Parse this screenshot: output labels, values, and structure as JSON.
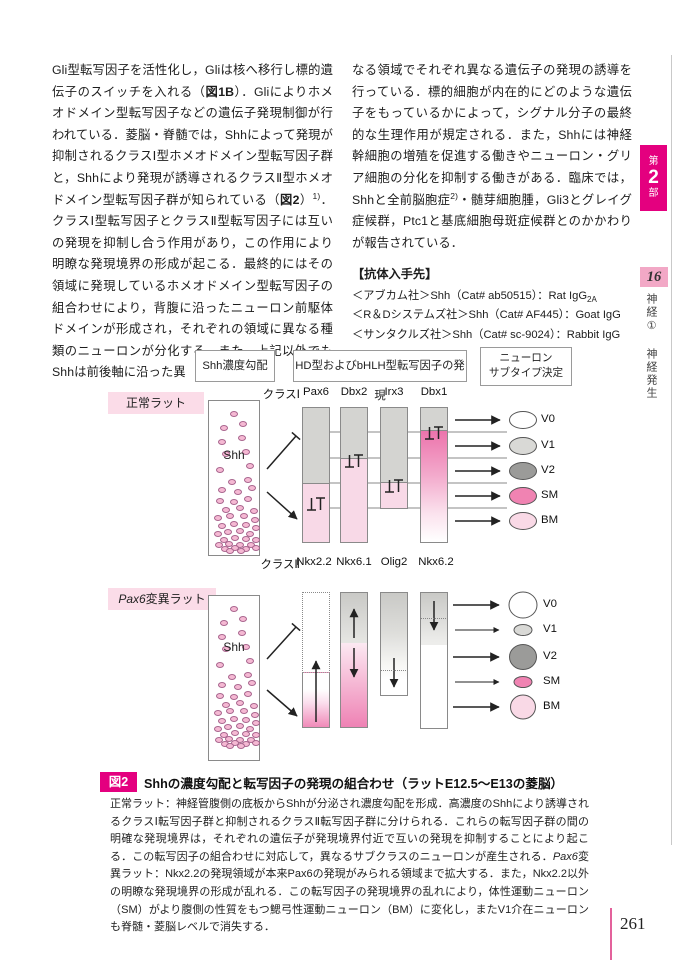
{
  "article": {
    "left_column_segments": [
      {
        "t": "Gli型転写因子を活性化し，Gliは核へ移行し標的遺伝子のスイッチを入れる（",
        "s": "n"
      },
      {
        "t": "図1B",
        "s": "b"
      },
      {
        "t": "）．Gliによりホメオドメイン型転写因子などの遺伝子発現制御が行われている．菱脳・脊髄では，Shhによって発現が抑制されるクラスⅠ型ホメオドメイン型転写因子群と，Shhにより発現が誘導されるクラスⅡ型ホメオドメイン型転写因子群が知られている（",
        "s": "n"
      },
      {
        "t": "図2",
        "s": "b"
      },
      {
        "t": "）",
        "s": "n"
      },
      {
        "t": "1)",
        "s": "sup"
      },
      {
        "t": "．クラスⅠ型転写因子とクラスⅡ型転写因子には互いの発現を抑制し合う作用があり，この作用により明瞭な発現境界の形成が起こる．最終的にはその領域に発現しているホメオドメイン型転写因子の組合わせにより，背腹に沿ったニューロン前駆体ドメインが形成され，それぞれの領域に異なる種類のニューロンが分化する．また，上記以外でもShhは前後軸に沿った異",
        "s": "n"
      }
    ],
    "right_column_segments": [
      {
        "t": "なる領域でそれぞれ異なる遺伝子の発現の誘導を行っている．標的細胞が内在的にどのような遺伝子をもっているかによって，シグナル分子の最終的な生理作用が規定される．また，Shhには神経幹細胞の増殖を促進する働きやニューロン・グリア細胞の分化を抑制する働きがある．臨床では，Shhと全前脳胞症",
        "s": "n"
      },
      {
        "t": "2)",
        "s": "sup"
      },
      {
        "t": "・髄芽細胞腫，Gli3とグレイグ症候群，Ptc1と基底細胞母斑症候群とのかかわりが報告されている．",
        "s": "n"
      }
    ],
    "antibody": {
      "heading": "【抗体入手先】",
      "lines": [
        [
          {
            "t": "＜アブカム社＞Shh（Cat# ab50515）：Rat IgG",
            "s": "n"
          },
          {
            "t": "2A",
            "s": "sub"
          }
        ],
        [
          {
            "t": "＜R＆Dシステムズ社＞Shh（Cat# AF445）：Goat IgG",
            "s": "n"
          }
        ],
        [
          {
            "t": "＜サンタクルズ社＞Shh（Cat# sc-9024）：Rabbit IgG",
            "s": "n"
          }
        ]
      ]
    }
  },
  "figure": {
    "box_gradient": "Shh濃度勾配",
    "box_expression": "HD型およびbHLH型転写因子の発現",
    "box_neuron_line1": "ニューロン",
    "box_neuron_line2": "サブタイプ決定",
    "repression_symbol": "⊥T",
    "normal": {
      "label": "正常ラット",
      "shh": "Shh",
      "class1": "クラスⅠ",
      "class2": "クラスⅡ",
      "top_genes": [
        "Pax6",
        "Dbx2",
        "Irx3",
        "Dbx1"
      ],
      "bottom_genes": [
        "Nkx2.2",
        "Nkx6.1",
        "Olig2",
        "Nkx6.2"
      ],
      "neurons": [
        {
          "label": "V0",
          "color": "#ffffff"
        },
        {
          "label": "V1",
          "color": "#d9d9d6"
        },
        {
          "label": "V2",
          "color": "#9b9b99"
        },
        {
          "label": "SM",
          "color": "#f083b2"
        },
        {
          "label": "BM",
          "color": "#f9d9e6"
        }
      ]
    },
    "mutant": {
      "label_segments": [
        {
          "t": "Pax6",
          "s": "i"
        },
        {
          "t": "変異ラット",
          "s": "n"
        }
      ],
      "shh": "Shh",
      "neurons": [
        {
          "label": "V0",
          "color": "#ffffff"
        },
        {
          "label": "V1",
          "color": "#d9d9d6"
        },
        {
          "label": "V2",
          "color": "#9b9b99"
        },
        {
          "label": "SM",
          "color": "#f083b2"
        },
        {
          "label": "BM",
          "color": "#f9d9e6"
        }
      ]
    },
    "caption": {
      "badge": "図2",
      "title": "Shhの濃度勾配と転写因子の発現の組合わせ（ラットE12.5～E13の菱脳）",
      "body_segments": [
        {
          "t": "正常ラット：神経管腹側の底板からShhが分泌され濃度勾配を形成．高濃度のShhにより誘導されるクラスⅠ転写因子群と抑制されるクラスⅡ転写因子群に分けられる．これらの転写因子群の間の明確な発現境界は，それぞれの遺伝子が発現境界付近で互いの発現を抑制することにより起こる．この転写因子の組合わせに対応して，異なるサブクラスのニューロンが産生される．",
          "s": "n"
        },
        {
          "t": "Pax6",
          "s": "i"
        },
        {
          "t": "変異ラット：Nkx2.2の発現領域が本来Pax6の発現がみられる領域まで拡大する．また，Nkx2.2以外の明瞭な発現境界の形成が乱れる．この転写因子の発現境界の乱れにより，体性運動ニューロン（SM）がより腹側の性質をもつ鰓弓性運動ニューロン（BM）に変化し，またV1介在ニューロンも脊髄・菱脳レベルで消失する．",
          "s": "n"
        }
      ]
    }
  },
  "sidebar": {
    "part_box": {
      "line1": "第",
      "line2": "2",
      "line3": "部"
    },
    "chapter_number": "16",
    "chapter_label_1": "神経①",
    "chapter_label_2": "神経発生"
  },
  "page_number": "261",
  "colors": {
    "accent_magenta": "#e4007f",
    "label_pink_bg": "#fbdce8",
    "chapter_pink_bg": "#f2a8c6",
    "bar_gray": "#d4d4d1",
    "bar_pink": "#f8d9e7",
    "bar_pink_strong": "#ee7fb2",
    "page_line_pink": "#e3619b"
  }
}
